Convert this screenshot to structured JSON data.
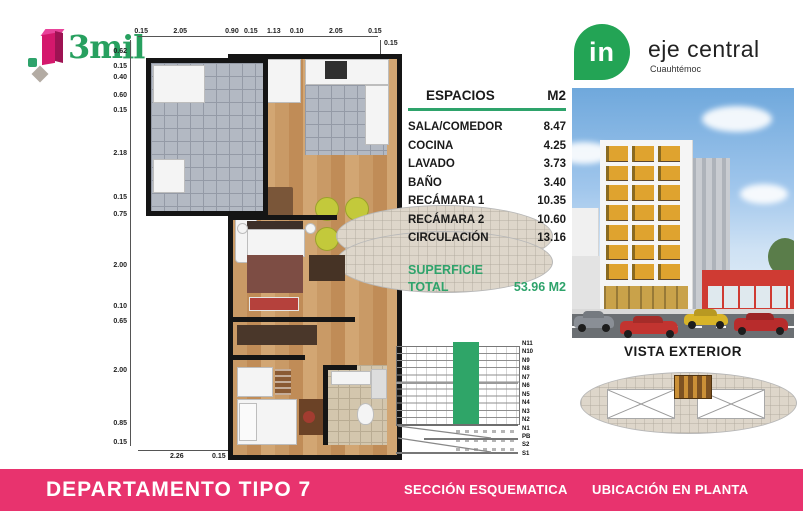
{
  "brand": {
    "name": "3mil"
  },
  "developer": {
    "pin_text": "in",
    "name": "eje central",
    "location": "Cuauhtémoc"
  },
  "spaces_table": {
    "title": "ESPACIOS",
    "unit_header": "M2",
    "rows": [
      {
        "label": "SALA/COMEDOR",
        "value": "8.47"
      },
      {
        "label": "COCINA",
        "value": "4.25"
      },
      {
        "label": "LAVADO",
        "value": "3.73"
      },
      {
        "label": "BAÑO",
        "value": "3.40"
      },
      {
        "label": "RECÁMARA 1",
        "value": "10.35"
      },
      {
        "label": "RECÁMARA 2",
        "value": "10.60"
      },
      {
        "label": "CIRCULACIÓN",
        "value": "13.16"
      }
    ],
    "total": {
      "line1": "SUPERFICIE",
      "line2": "TOTAL",
      "value": "53.96 M2"
    }
  },
  "floorplan": {
    "dims_top": [
      "0.15",
      "2.05",
      "0.90",
      "0.15",
      "1.13",
      "0.10",
      "2.05",
      "0.15"
    ],
    "dims_left": [
      "0.62",
      "0.15",
      "0.40",
      "0.60",
      "0.15",
      "2.18",
      "0.15",
      "0.75",
      "2.00",
      "0.10",
      "0.65",
      "2.00",
      "0.85",
      "0.15"
    ],
    "dims_right": [
      "0.15",
      "0.62",
      "3.73",
      "2.00",
      "0.60",
      "0.75",
      "0.50",
      "0.15",
      "0.50",
      "0.90",
      "0.15"
    ],
    "dims_bottom": [
      "2.26",
      "0.15",
      "2.88",
      "0.15",
      "1.10",
      "0.20",
      "0.15"
    ]
  },
  "section": {
    "levels": [
      "N11",
      "N10",
      "N9",
      "N8",
      "N7",
      "N6",
      "N5",
      "N4",
      "N3",
      "N2",
      "N1",
      "PB",
      "S2",
      "S1"
    ]
  },
  "exterior": {
    "caption": "VISTA EXTERIOR"
  },
  "footer": {
    "title": "DEPARTAMENTO TIPO 7",
    "section_label": "SECCIÓN ESQUEMATICA",
    "location_label": "UBICACIÓN EN PLANTA"
  },
  "colors": {
    "pink": "#E8336E",
    "green": "#2EA36B",
    "pin_green": "#23A455"
  }
}
